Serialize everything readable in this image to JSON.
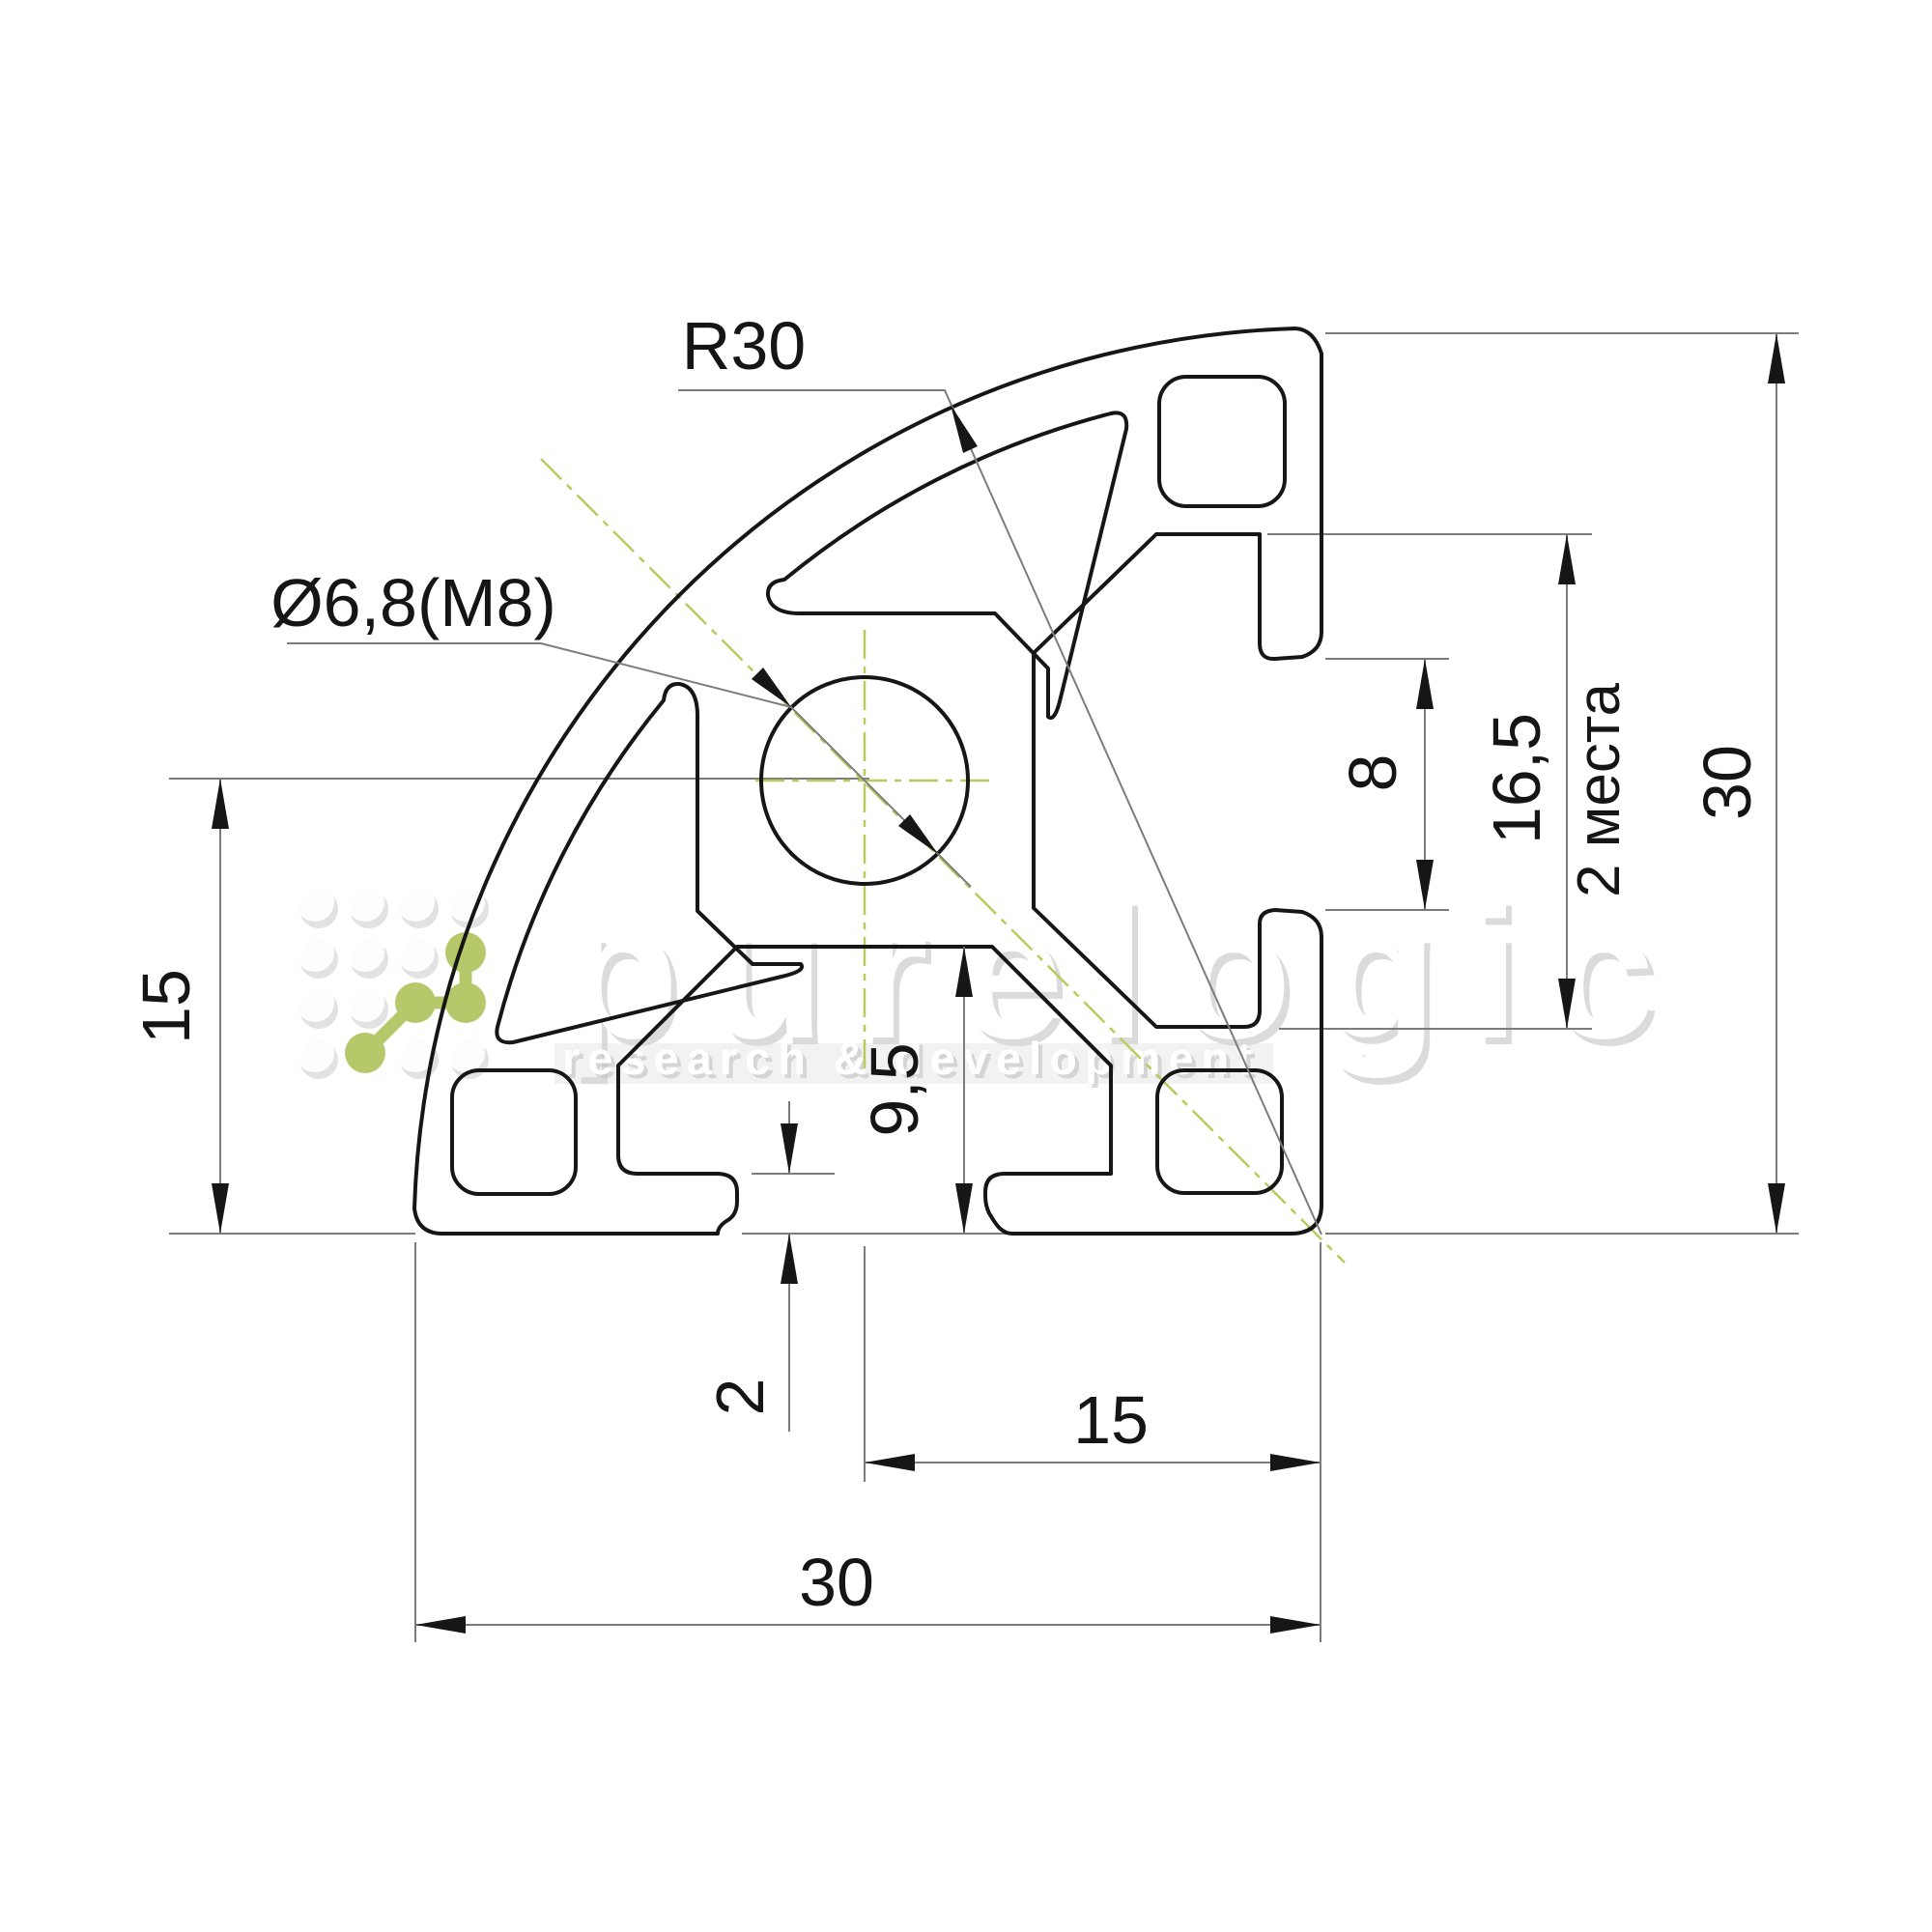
{
  "drawing": {
    "labels": {
      "radius": "R30",
      "center_hole": "Ø6,8(M8)",
      "left_height": "15",
      "slot_opening": "8",
      "groove_span": "16,5",
      "groove_span_note": "2 места",
      "overall_height": "30",
      "slot_depth": "9,5",
      "lip_thickness": "2",
      "half_width": "15",
      "overall_width": "30"
    },
    "watermark": {
      "brand": "purelogic",
      "tagline": "research & development"
    },
    "colors": {
      "outline": "#161616",
      "thin_line": "#7c7c7c",
      "centerline_green": "#b9cb5e",
      "logo_green": "#b5c96a",
      "background": "#ffffff"
    }
  }
}
